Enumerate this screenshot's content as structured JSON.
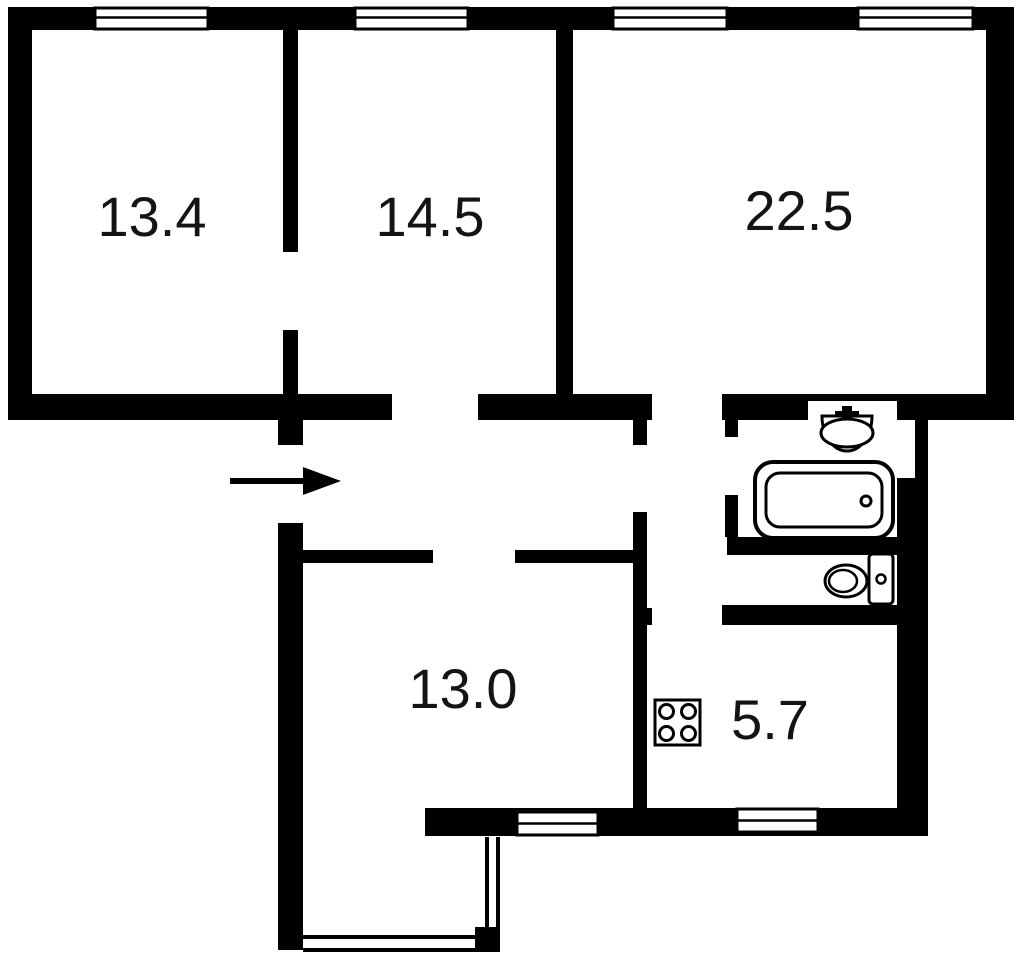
{
  "floorplan": {
    "title": "Apartment floor plan",
    "colors": {
      "wall": "#000000",
      "background": "#ffffff",
      "label": "#141414",
      "fixture_stroke": "#000000"
    },
    "rooms": [
      {
        "key": "room-top-left",
        "area": "13.4"
      },
      {
        "key": "room-top-middle",
        "area": "14.5"
      },
      {
        "key": "room-top-right",
        "area": "22.5"
      },
      {
        "key": "room-bottom",
        "area": "13.0"
      },
      {
        "key": "kitchen",
        "area": "5.7"
      }
    ],
    "fixtures": [
      {
        "icon": "sink-icon",
        "room": "bathroom"
      },
      {
        "icon": "bathtub-icon",
        "room": "bathroom"
      },
      {
        "icon": "toilet-icon",
        "room": "toilet"
      },
      {
        "icon": "stove-icon",
        "room": "kitchen"
      }
    ],
    "entrance": {
      "icon": "entrance-arrow-icon",
      "direction": "right"
    },
    "window_count": 6,
    "balcony": true
  }
}
